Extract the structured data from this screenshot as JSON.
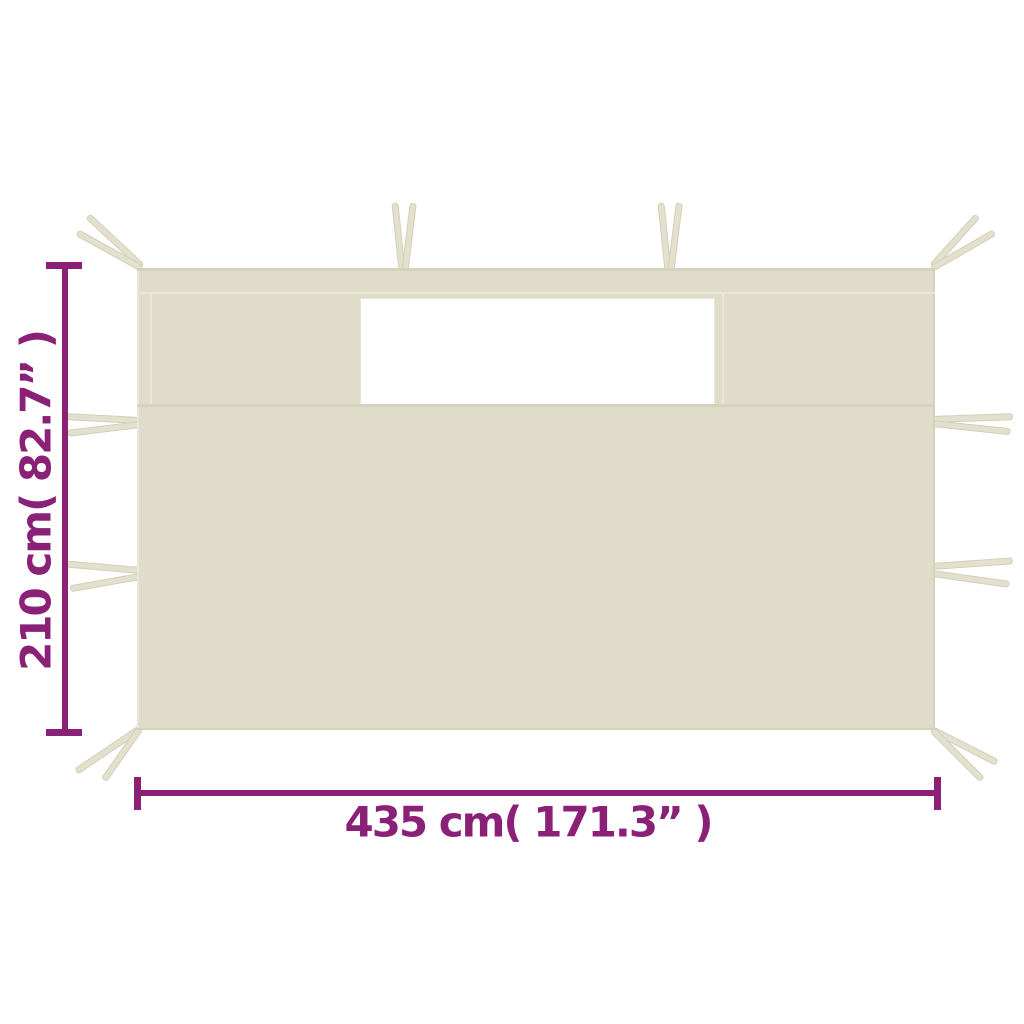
{
  "diagram": {
    "subject": "Gazebo sidewall panel with window and tie straps",
    "height_dimension": {
      "label": "210 cm( 82.7” )"
    },
    "width_dimension": {
      "label": "435 cm( 171.3” )"
    }
  },
  "colors": {
    "background": "#ffffff",
    "fabric": "#dfdcc9",
    "fabric_dark": "#d4d1bc",
    "fabric_light": "#eae7d8",
    "strap": "#e3e0ce",
    "strap_edge": "#d2cfba",
    "window": "#ffffff",
    "dimension": "#8b2177"
  }
}
